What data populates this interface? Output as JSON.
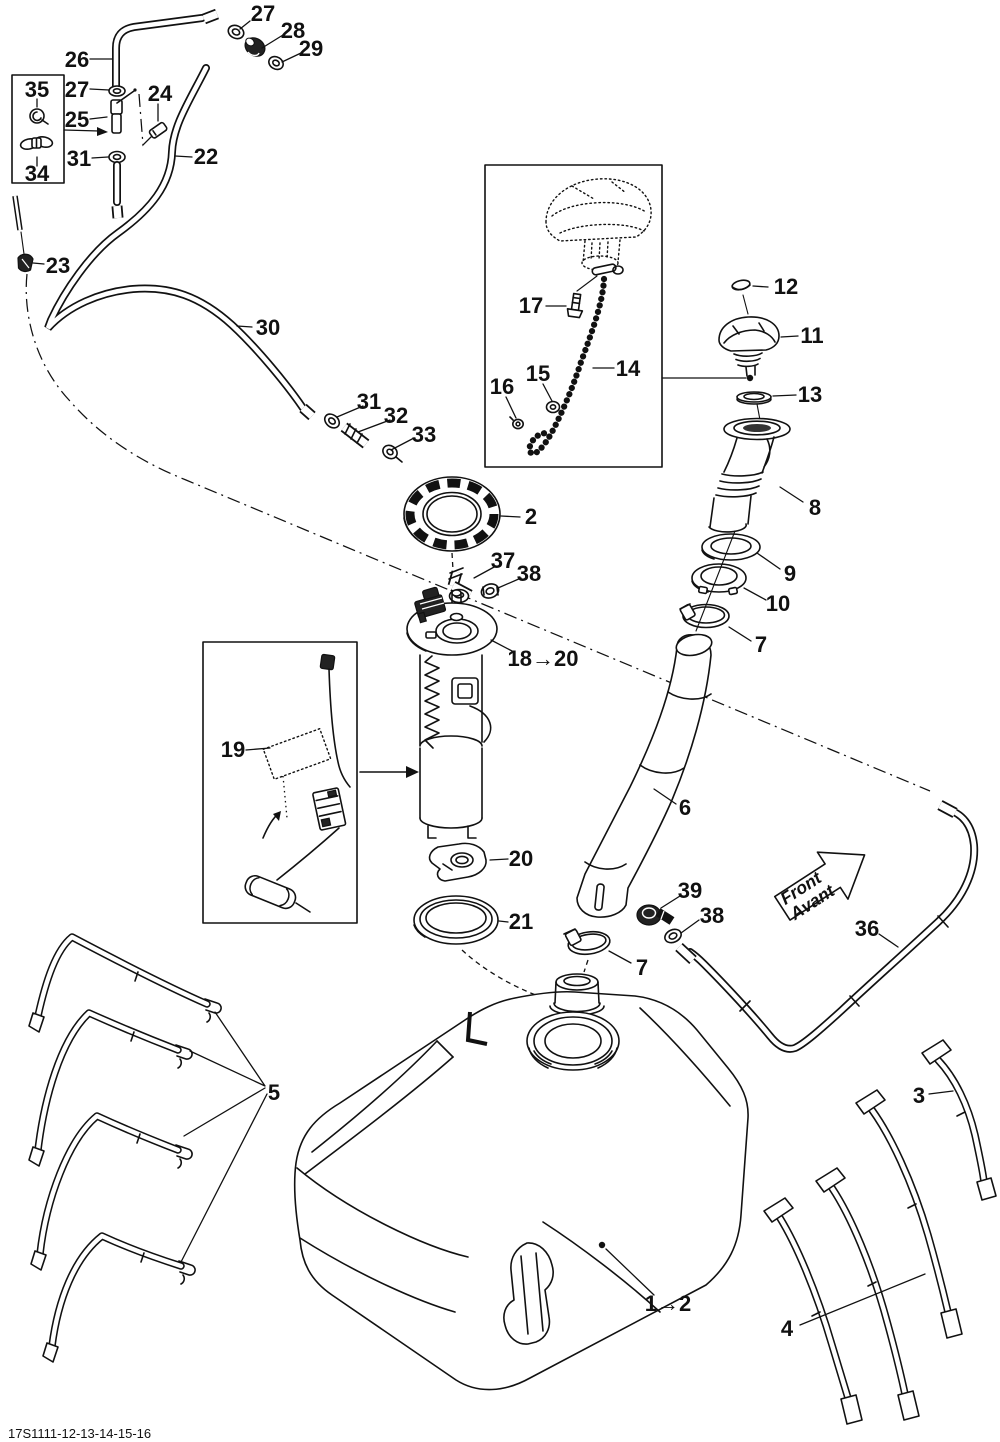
{
  "diagram": {
    "sheet_code": "17S1111-12-13-14-15-16",
    "front_arrow": {
      "line1": "Front",
      "line2": "Avant"
    },
    "callouts": {
      "n1_2": "1→2",
      "n2": "2",
      "n3": "3",
      "n4": "4",
      "n5": "5",
      "n6": "6",
      "n7a": "7",
      "n7b": "7",
      "n8": "8",
      "n9": "9",
      "n10": "10",
      "n11": "11",
      "n12": "12",
      "n13": "13",
      "n14": "14",
      "n15": "15",
      "n16": "16",
      "n17": "17",
      "n18_20": "18→20",
      "n19": "19",
      "n20": "20",
      "n21": "21",
      "n22": "22",
      "n23": "23",
      "n24": "24",
      "n25": "25",
      "n26": "26",
      "n27a": "27",
      "n27b": "27",
      "n28": "28",
      "n29": "29",
      "n30": "30",
      "n31a": "31",
      "n31b": "31",
      "n32": "32",
      "n33": "33",
      "n34": "34",
      "n35": "35",
      "n36": "36",
      "n37": "37",
      "n38a": "38",
      "n38b": "38",
      "n39": "39"
    }
  }
}
